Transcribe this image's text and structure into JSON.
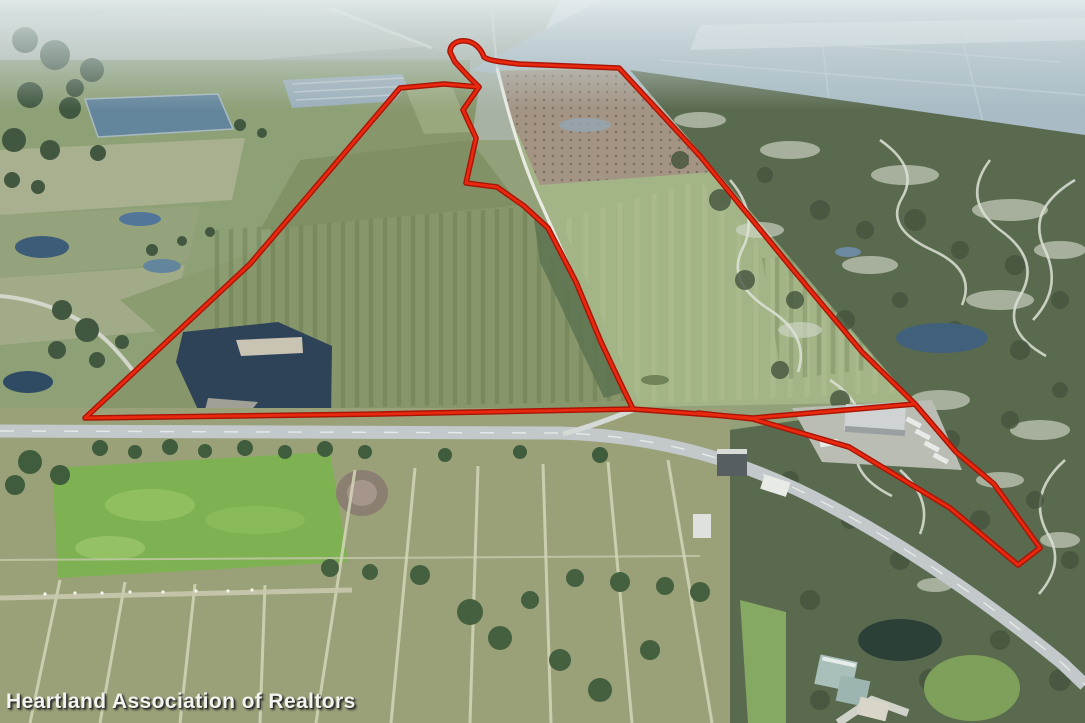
{
  "meta": {
    "kind": "aerial-listing-photo",
    "subject": "farmland parcel outlined in red with adjacent highway, ponds and scrubland"
  },
  "watermark": {
    "text": "Heartland Association of Realtors"
  },
  "boundary": {
    "color_outer": "#a81405",
    "color_inner": "#e8290f",
    "main_parcel_path": "M 85 418 L 250 264 L 400 88 L 444 84 L 479 87 L 468 76 L 455 62 L 450 52 C 450 44 458 40 466 41 C 475 42 481 49 484 57 C 489 61 503 62 519 64 L 619 68 L 700 156 L 790 266 L 862 352 L 915 404 L 753 418 L 633 409 L 380 414 Z",
    "interior_line_path": "M 479 87 L 463 110 L 476 138 L 466 183 L 497 187 L 524 206 L 548 228 L 576 282 L 601 342 L 618 378 L 633 409",
    "southeast_wedge_path": "M 915 404 L 956 452 L 994 484 L 1040 548 L 1018 565 L 950 508 L 849 447 L 753 419 L 698 413"
  }
}
